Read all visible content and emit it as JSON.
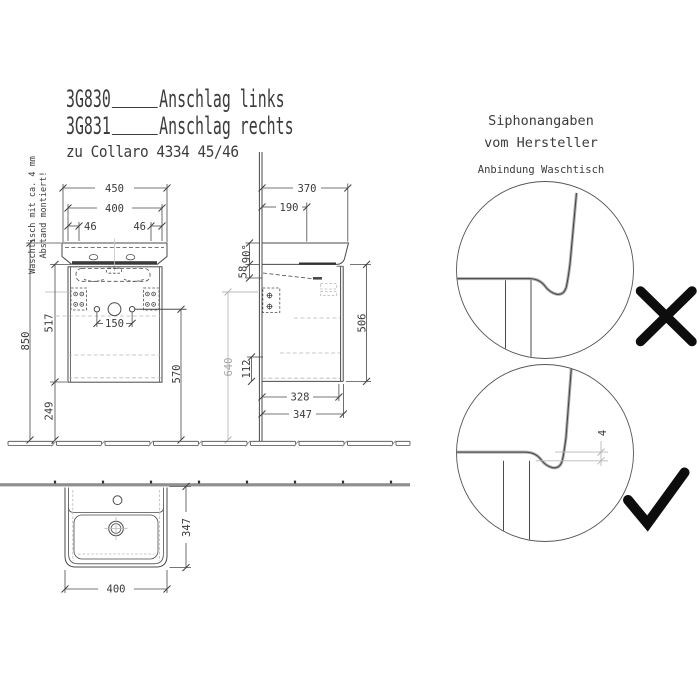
{
  "title": {
    "row1": {
      "code": "3G830",
      "label": "Anschlag links"
    },
    "row2": {
      "code": "3G831",
      "label": "Anschlag rechts"
    },
    "subtitle": "zu Collaro 4334 45/46"
  },
  "mounting_note": {
    "line1": "Waschtisch mit ca. 4 mm",
    "line2": "Abstand montiert!"
  },
  "front_view": {
    "dims": {
      "basin_width": "450",
      "cabinet_width": "400",
      "anchor_offset_left": "46",
      "anchor_offset_right": "46",
      "total_height": "850",
      "cabinet_height": "517",
      "clearance_below": "249",
      "connection_spacing": "150",
      "siphon_height": "570",
      "reference_height": "640"
    }
  },
  "side_view": {
    "dims": {
      "basin_depth": "370",
      "tap_distance": "190",
      "basin_edge_height": "90°",
      "apron_height": "58",
      "rear_clearance": "112",
      "cabinet_height": "506",
      "body_depth": "328",
      "overall_depth": "347"
    }
  },
  "plan_view": {
    "dims": {
      "basin_width": "400",
      "basin_depth": "347"
    }
  },
  "siphon_panel": {
    "heading1": "Siphonangaben",
    "heading2": "vom Hersteller",
    "subheading": "Anbindung Waschtisch",
    "gap_dim": "4"
  },
  "colors": {
    "line": "#4a4a4a",
    "light_line": "#b8b8b8",
    "wall_fill": "#8f8f8f",
    "mark": "#0d0d0d"
  }
}
